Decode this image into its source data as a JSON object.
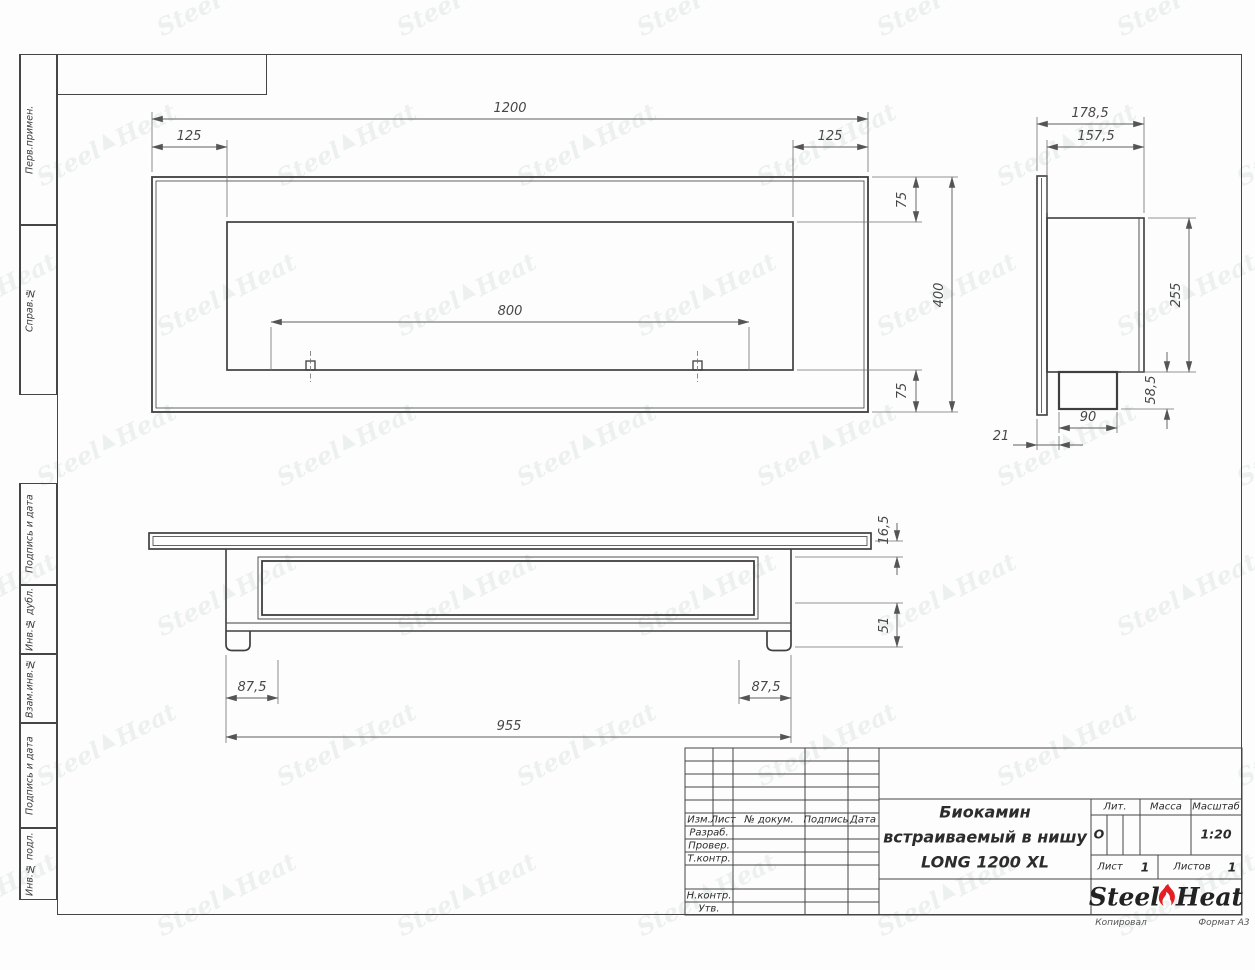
{
  "page": {
    "bg": "#fdfdfd",
    "line_color": "#3f3f3f",
    "dim_color": "#5f5f5f",
    "accent_red": "#e31e24"
  },
  "watermark": {
    "part1": "Steel",
    "part2": "Heat"
  },
  "margin_stamps": [
    {
      "label": "Перв.примен."
    },
    {
      "label": "Справ.№"
    },
    {
      "label": "Подпись и дата"
    },
    {
      "label": "Инв.№ дубл."
    },
    {
      "label": "Взам.инв.№"
    },
    {
      "label": "Подпись и дата"
    },
    {
      "label": "Инв.№ подл."
    }
  ],
  "views": {
    "front": {
      "dims": {
        "total_width": "1200",
        "left_offset": "125",
        "right_offset": "125",
        "opening_width": "800",
        "top_band": "75",
        "bottom_band": "75",
        "height": "400"
      }
    },
    "side": {
      "dims": {
        "depth_total": "178,5",
        "depth_body": "157,5",
        "body_height": "255",
        "burner_height": "58,5",
        "burner_width": "90",
        "flange_offset": "21"
      }
    },
    "bottom": {
      "dims": {
        "flange_thickness": "16,5",
        "base_height": "51",
        "left_inset": "87,5",
        "right_inset": "87,5",
        "body_length": "955"
      }
    }
  },
  "title_block": {
    "cols": {
      "izm": "Изм.",
      "list": "Лист",
      "doc": "№ докум.",
      "sign": "Подпись",
      "date": "Дата"
    },
    "rows": {
      "razrab": "Разраб.",
      "prover": "Провер.",
      "tkontr": "Т.контр.",
      "nkontr": "Н.контр.",
      "utv": "Утв."
    },
    "title_line1": "Биокамин",
    "title_line2": "встраиваемый в нишу",
    "title_line3": "LONG 1200 XL",
    "lit_label": "Лит.",
    "lit_value": "О",
    "mass_label": "Масса",
    "scale_label": "Масштаб",
    "scale_value": "1:20",
    "sheet_label": "Лист",
    "sheet_value": "1",
    "sheets_label": "Листов",
    "sheets_value": "1",
    "logo": {
      "steel": "Steel",
      "heat": "Heat"
    },
    "copied_by": "Копировал",
    "format": "Формат А3"
  }
}
